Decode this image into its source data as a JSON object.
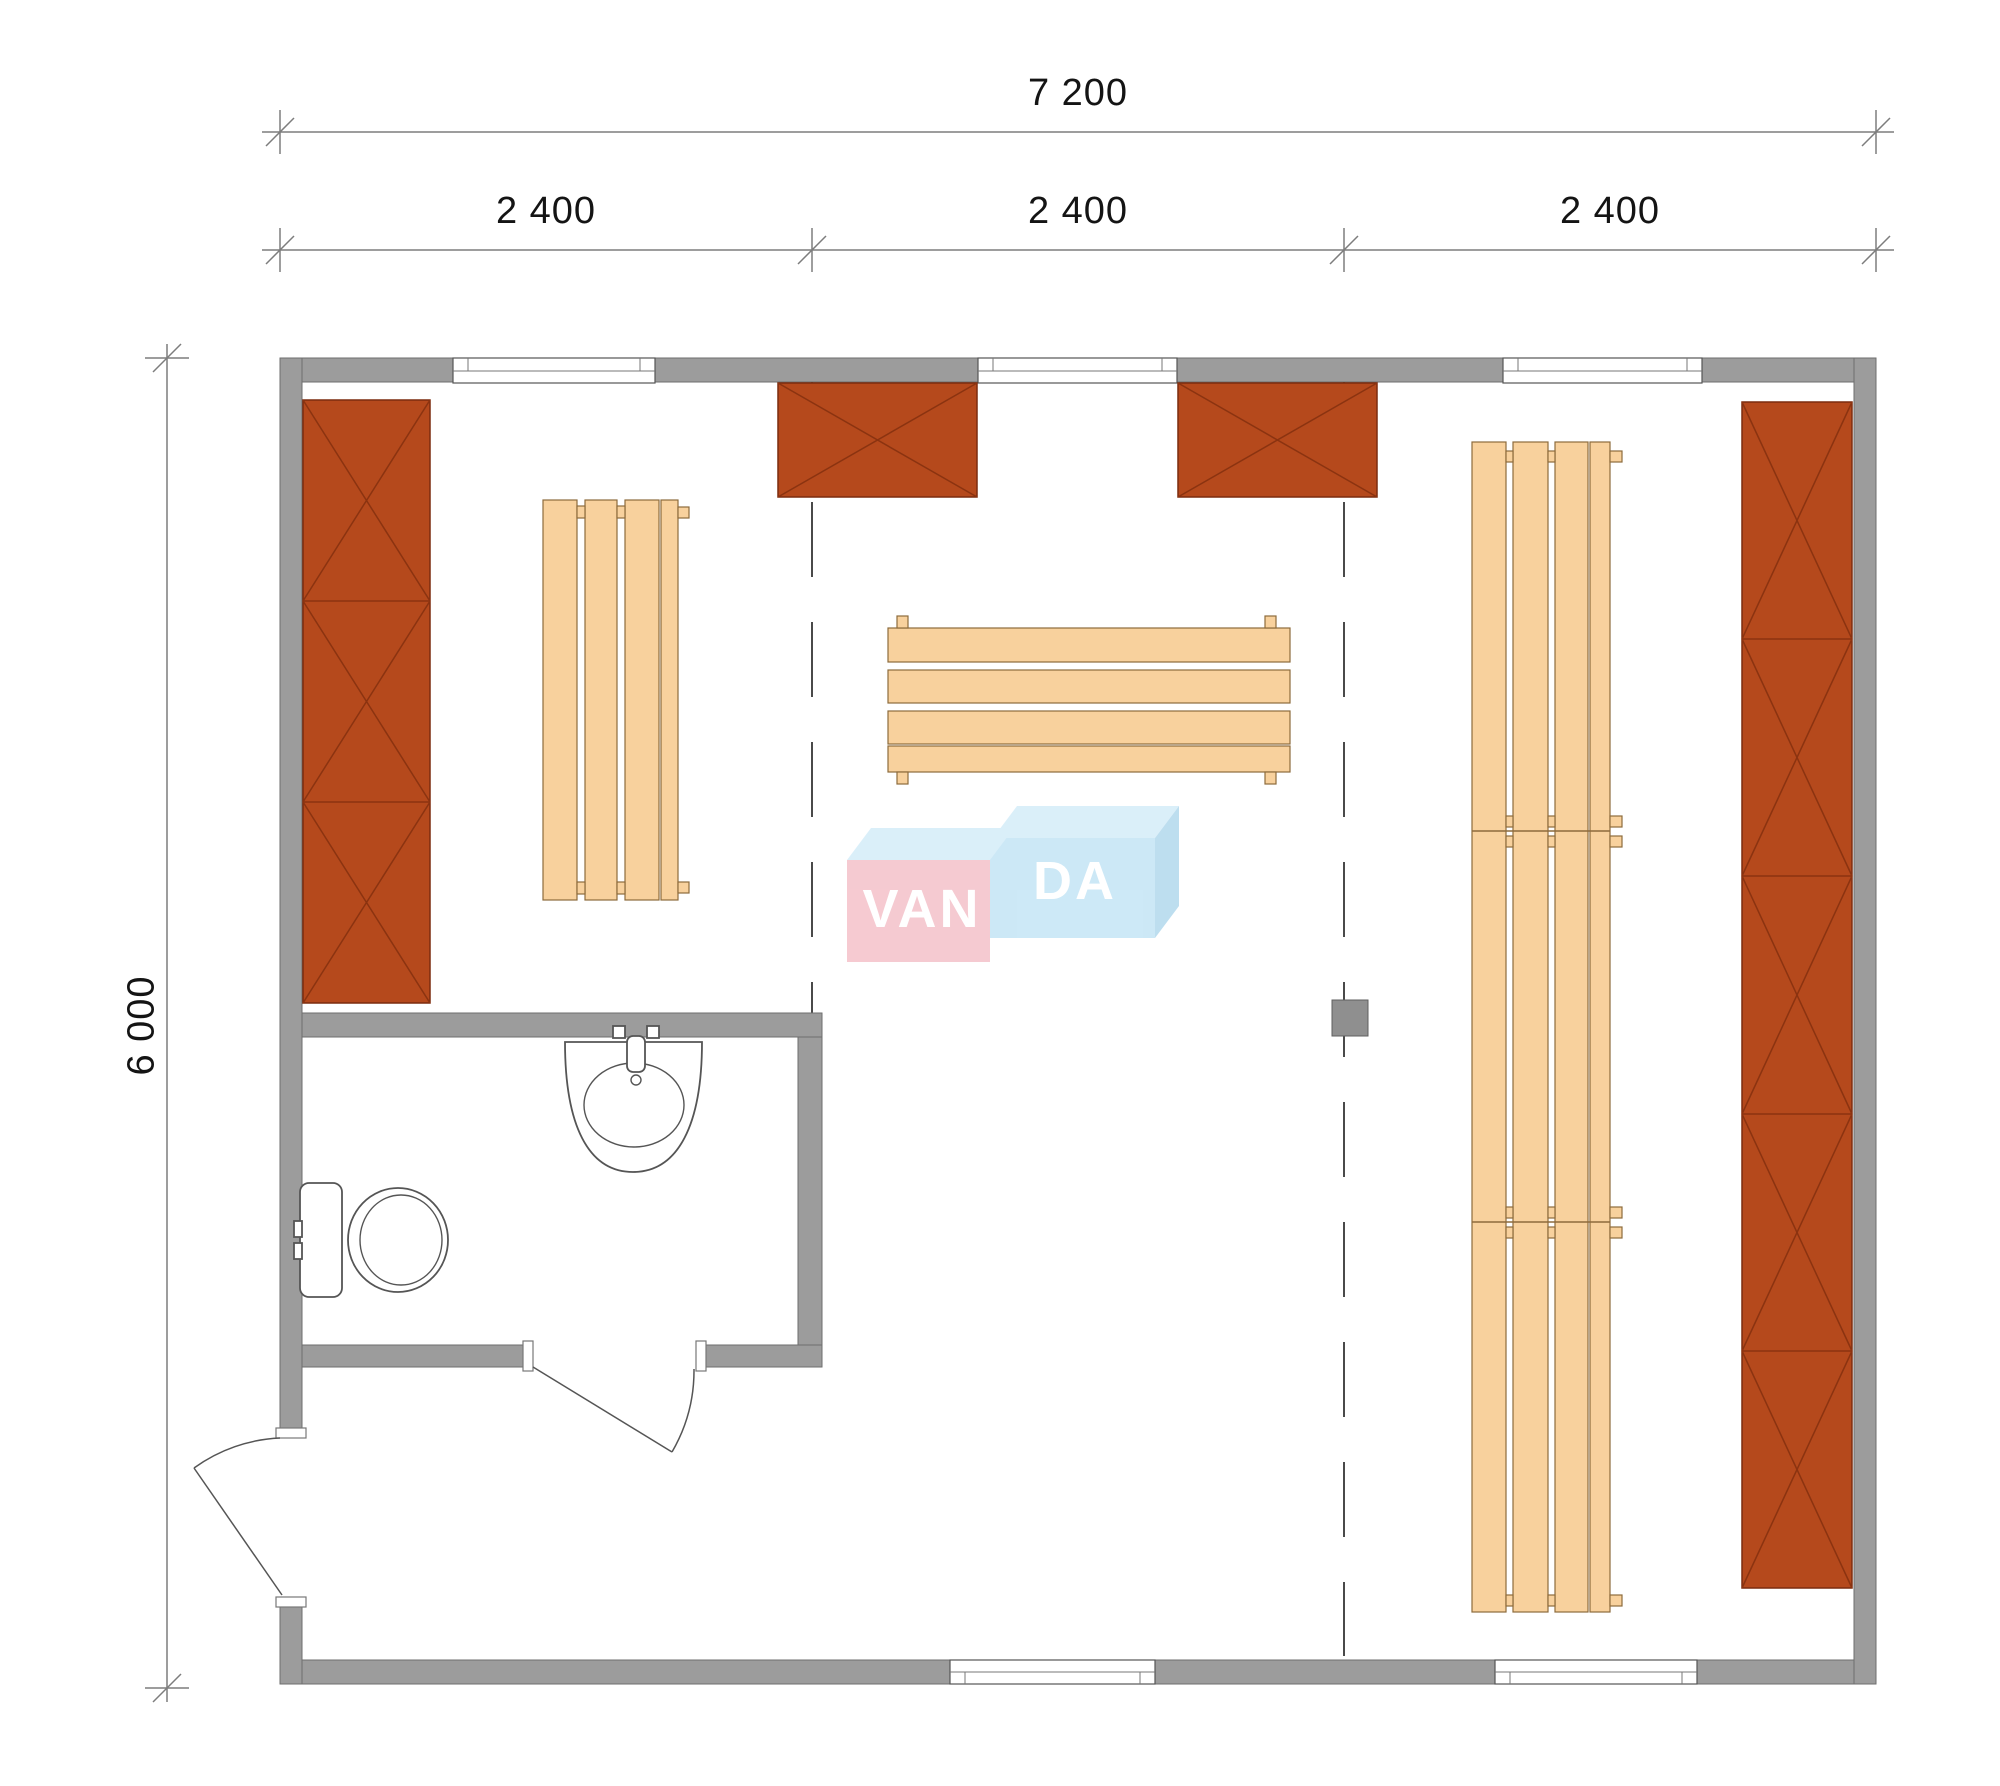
{
  "dimensions": {
    "total_width_label": "7 200",
    "module_labels": [
      "2 400",
      "2 400",
      "2 400"
    ],
    "height_label": "6 000"
  },
  "logo": {
    "part1": "VAN",
    "part2": "DA"
  },
  "colors": {
    "wall": "#9c9c9c",
    "cabinet": "#b5491c",
    "bench": "#f8d19d",
    "dash": "#4a4a4a",
    "text": "#141414",
    "dimline": "#7d7d7d",
    "logo_pink": "#f5c6ce",
    "logo_blue": "#c9e7f6",
    "logo_blue_light": "#d8eef9",
    "logo_blue_side": "#b9dcee"
  }
}
